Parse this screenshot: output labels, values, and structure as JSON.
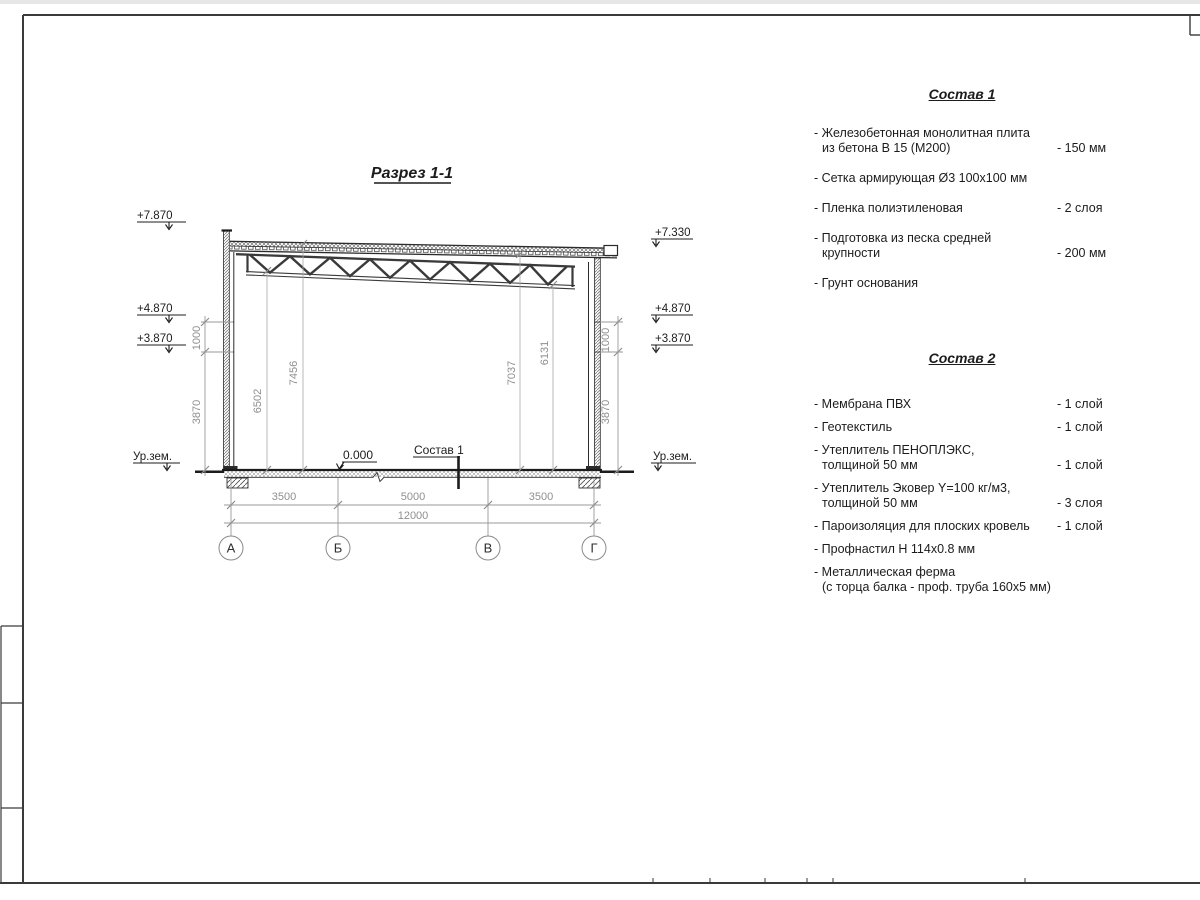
{
  "drawing": {
    "title": "Разрез 1-1",
    "elev": {
      "left_top": "+7.870",
      "left_mid": "+4.870",
      "left_low": "+3.870",
      "left_ground": "Ур.зем.",
      "right_top": "+7.330",
      "right_mid": "+4.870",
      "right_low": "+3.870",
      "right_ground": "Ур.зем."
    },
    "vdims": {
      "left_1000": "1000",
      "left_3870": "3870",
      "right_1000": "1000",
      "right_3870": "3870",
      "h6502": "6502",
      "h7456": "7456",
      "h7037": "7037",
      "h6131": "6131"
    },
    "hdims": {
      "d1": "3500",
      "d2": "5000",
      "d3": "3500",
      "total": "12000"
    },
    "zero_mark": "0.000",
    "floor_note": "Состав 1",
    "axes": {
      "a": "А",
      "b": "Б",
      "v": "В",
      "g": "Г"
    }
  },
  "lists": {
    "sostav1": {
      "title": "Состав 1",
      "items": [
        {
          "line1": "- Железобетонная  монолитная плита",
          "line2": "из бетона В 15 (М200)",
          "value": "- 150 мм"
        },
        {
          "line1": "- Сетка армирующая Ø3 100x100 мм"
        },
        {
          "line1": "- Пленка полиэтиленовая",
          "value": "-  2 слоя"
        },
        {
          "line1": "- Подготовка из песка средней",
          "line2": "крупности",
          "value": "- 200 мм"
        },
        {
          "line1": "- Грунт основания"
        }
      ]
    },
    "sostav2": {
      "title": "Состав 2",
      "items": [
        {
          "line1": "- Мембрана ПВХ",
          "value": "- 1 слой"
        },
        {
          "line1": "- Геотекстиль",
          "value": "- 1 слой"
        },
        {
          "line1": "- Утеплитель ПЕНОПЛЭКС,",
          "line2": "толщиной 50 мм",
          "value": "- 1 слой"
        },
        {
          "line1": "- Утеплитель Эковер Y=100 кг/м3,",
          "line2": "толщиной 50 мм",
          "value": "- 3 слоя"
        },
        {
          "line1": "- Пароизоляция для плоских кровель",
          "value": "- 1 слой"
        },
        {
          "line1": "- Профнастил Н 114x0.8 мм"
        },
        {
          "line1": "- Металлическая ферма",
          "line2": "(с торца балка - проф. труба 160x5 мм)"
        }
      ]
    }
  }
}
